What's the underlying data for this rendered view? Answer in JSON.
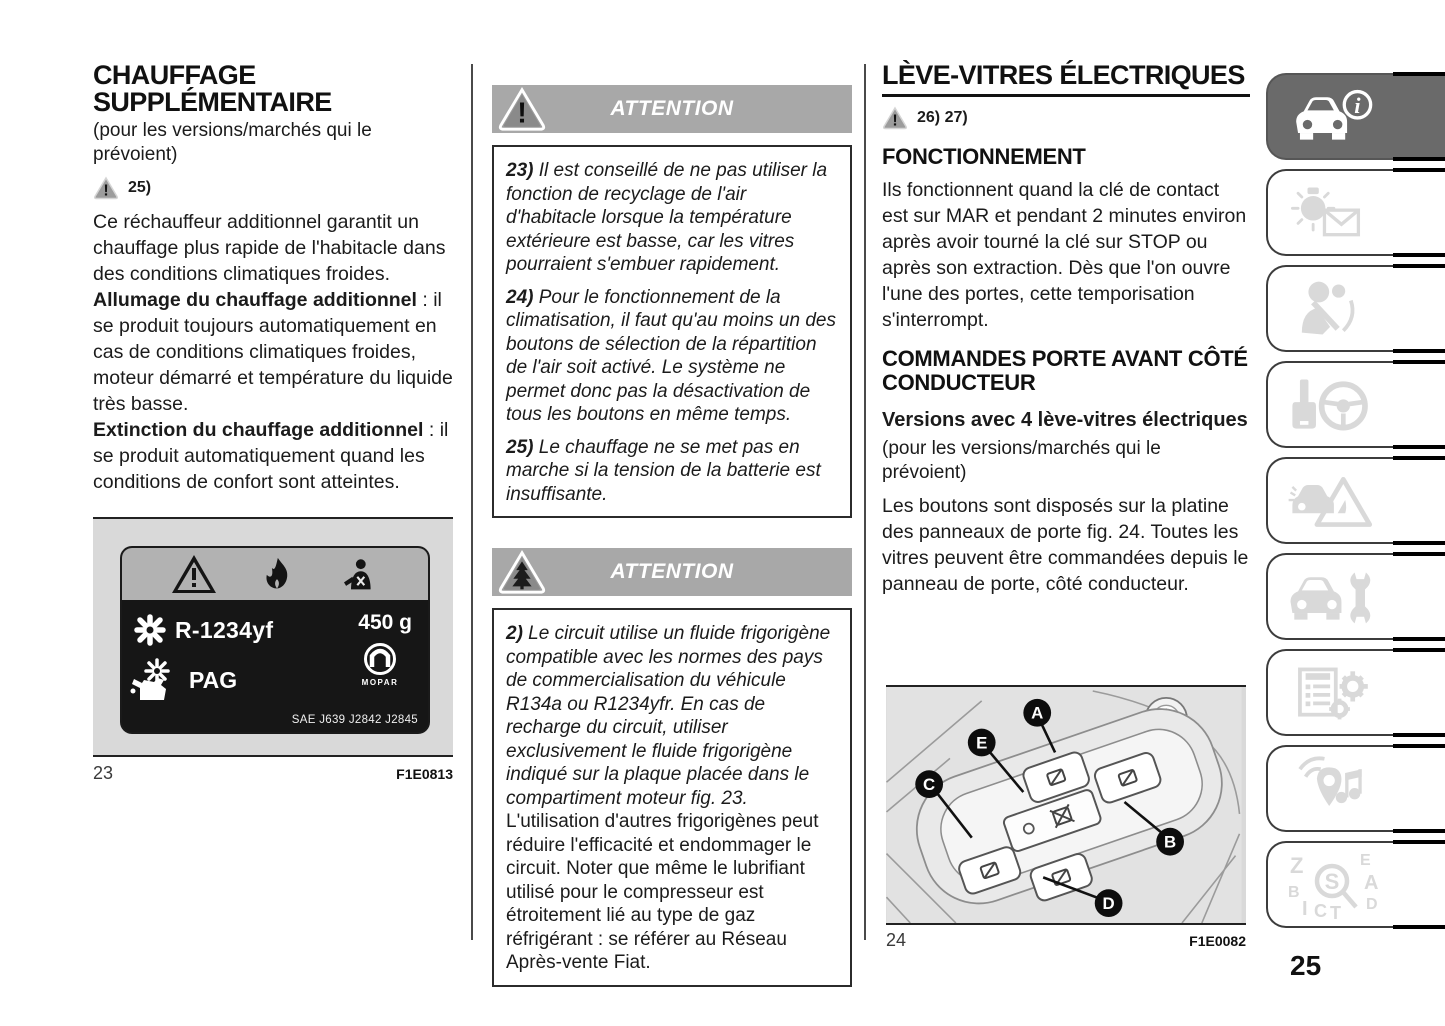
{
  "page": {
    "number": "25"
  },
  "colors": {
    "attention_bar_gray": "#a8a8a8",
    "active_tab_gray": "#6a6a6a",
    "sidebar_icon_gray": "#d9d9d9",
    "label_background": "#161616",
    "label_band_gray": "#b2b2b2",
    "figure_background": "#d9d9d9"
  },
  "left": {
    "title": "CHAUFFAGE SUPPLÉMENTAIRE",
    "note": "(pour les versions/marchés qui le prévoient)",
    "warning_icon": "warning-triangle-icon",
    "warning_ref": "25)",
    "para1": "Ce réchauffeur additionnel garantit un chauffage plus rapide de l'habitacle dans des conditions climatiques froides.",
    "bold1": "Allumage du chauffage additionnel",
    "bold1_rest": " : il se produit toujours automatiquement en cas de conditions climatiques froides, moteur démarré et température du liquide très basse.",
    "bold2": "Extinction du chauffage additionnel",
    "bold2_rest": " : il se produit automatiquement quand les conditions de confort sont atteintes.",
    "figure": {
      "number": "23",
      "code": "F1E0813",
      "label": {
        "icons": [
          "warning-triangle-icon",
          "flammable-icon",
          "technician-icon",
          "refrigerant-snowflake-icon",
          "oil-can-icon",
          "mopar-logo"
        ],
        "refrigerant": "R-1234yf",
        "quantity": "450 g",
        "oil": "PAG",
        "brand": "MOPAR",
        "standards": "SAE J639 J2842 J2845"
      }
    }
  },
  "middle": {
    "box1": {
      "icon": "warning-triangle-icon",
      "header": "ATTENTION",
      "items": [
        {
          "num": "23)",
          "text": " Il est conseillé de ne pas utiliser la fonction de recyclage de l'air d'habitacle lorsque la température extérieure est basse, car les vitres pourraient s'embuer rapidement."
        },
        {
          "num": "24)",
          "text": " Pour le fonctionnement de la climatisation, il faut qu'au moins un des boutons de sélection de la répartition de l'air soit activé. Le système ne permet donc pas la désactivation de tous les boutons en même temps."
        },
        {
          "num": "25)",
          "text": "  Le chauffage ne se met pas en marche si la tension de la batterie est insuffisante."
        }
      ]
    },
    "box2": {
      "icon": "environment-triangle-icon",
      "header": "ATTENTION",
      "item": {
        "num": "2)",
        "text_italic": " Le circuit utilise un fluide frigorigène compatible avec les normes des pays de commercialisation du véhicule R134a ou R1234yfr. En cas de recharge du circuit, utiliser exclusivement le fluide frigorigène indiqué sur la plaque placée dans le compartiment moteur fig. 23.",
        "text_regular": "L'utilisation d'autres frigorigènes peut réduire l'efficacité et endommager le circuit. Noter que même le lubrifiant utilisé pour le compresseur est étroitement lié au type de gaz réfrigérant : se référer au Réseau Après-vente Fiat."
      }
    }
  },
  "right": {
    "title": "LÈVE-VITRES ÉLECTRIQUES",
    "warning_icon": "warning-triangle-icon",
    "warning_refs": "26) 27)",
    "s1_title": "FONCTIONNEMENT",
    "s1_text": "Ils fonctionnent quand la clé de contact est sur MAR et pendant 2 minutes environ après avoir tourné la clé sur STOP ou après son extraction. Dès que l'on ouvre l'une des portes, cette temporisation s'interrompt.",
    "s2_title": "COMMANDES PORTE AVANT CÔTÉ CONDUCTEUR",
    "s2_bold": "Versions avec 4 lève-vitres électriques",
    "s2_note": "(pour les versions/marchés qui le prévoient)",
    "s2_text": "Les boutons sont disposés sur la platine des panneaux de porte fig. 24. Toutes les vitres peuvent être commandées depuis le panneau de porte, côté conducteur.",
    "figure": {
      "number": "24",
      "code": "F1E0082",
      "markers": [
        "A",
        "B",
        "C",
        "D",
        "E"
      ]
    }
  },
  "sidebar": {
    "tabs": [
      {
        "icon": "car-info-icon",
        "active": true
      },
      {
        "icon": "warning-lights-messages-icon",
        "active": false
      },
      {
        "icon": "safety-icon",
        "active": false
      },
      {
        "icon": "starting-driving-icon",
        "active": false
      },
      {
        "icon": "emergency-icon",
        "active": false
      },
      {
        "icon": "maintenance-icon",
        "active": false
      },
      {
        "icon": "technical-data-icon",
        "active": false
      },
      {
        "icon": "multimedia-icon",
        "active": false
      },
      {
        "icon": "alphabetical-index-icon",
        "active": false
      }
    ]
  }
}
